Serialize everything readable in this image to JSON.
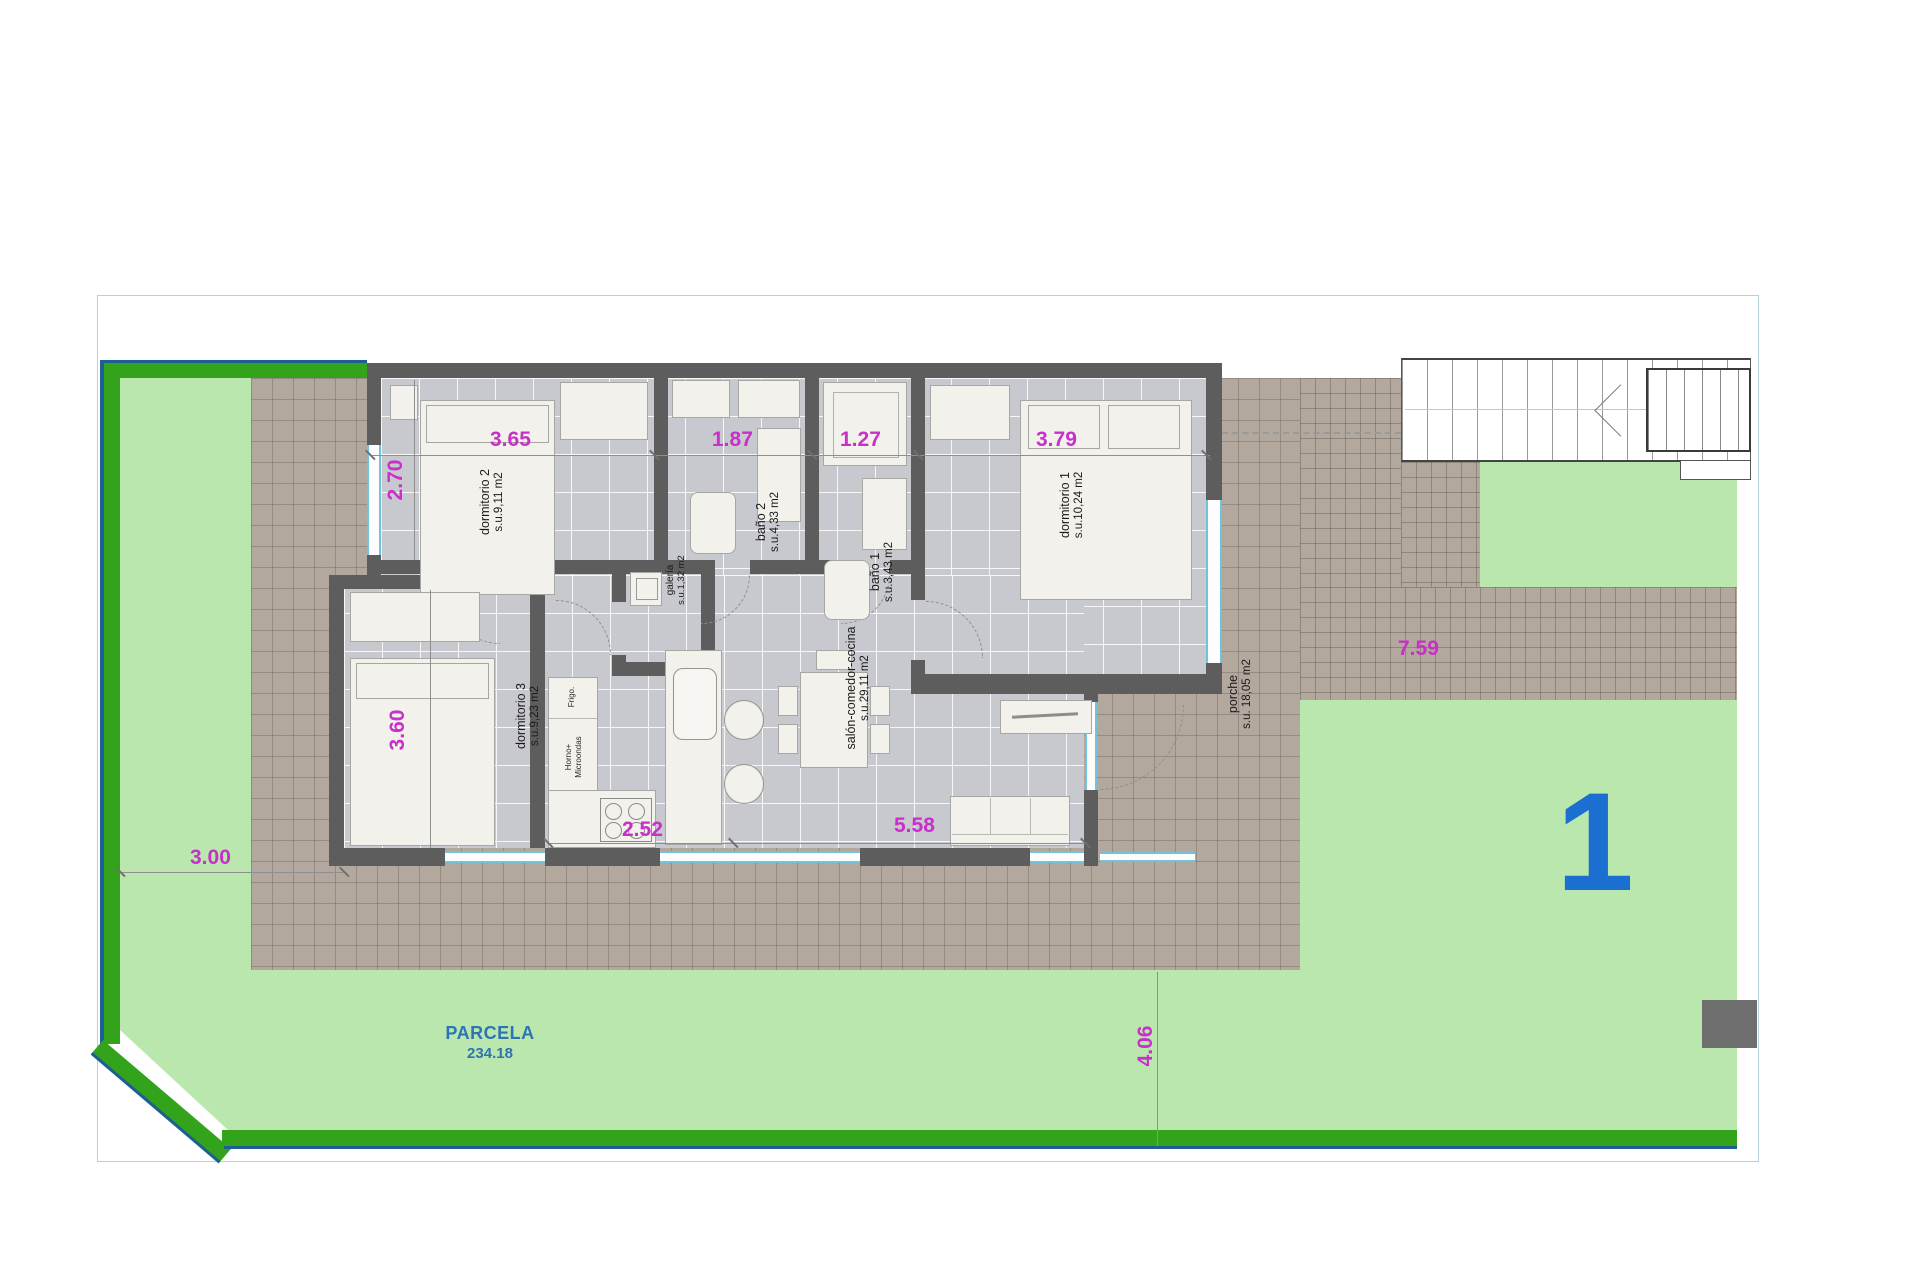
{
  "plan": {
    "unit_number": "1",
    "parcel": {
      "label": "PARCELA",
      "area": "234.18"
    },
    "rooms": {
      "dormitorio2": {
        "name": "dormitorio 2",
        "area": "s.u.9,11 m2"
      },
      "bano2": {
        "name": "baño 2",
        "area": "s.u.4,33 m2"
      },
      "bano1": {
        "name": "baño 1",
        "area": "s.u.3,43 m2"
      },
      "dormitorio1": {
        "name": "dormitorio 1",
        "area": "s.u.10,24 m2"
      },
      "galeria": {
        "name": "galería",
        "area": "s.u.1,32 m2"
      },
      "dormitorio3": {
        "name": "dormitorio 3",
        "area": "s.u.9,23 m2"
      },
      "salon": {
        "name": "salón-comedor-cocina",
        "area": "s.u.29,11 m2"
      },
      "porche": {
        "name": "porche",
        "area": "s.u. 18,05 m2"
      }
    },
    "kitchen": {
      "fridge": "Frigo.",
      "oven_line1": "Horno+",
      "oven_line2": "Microondas"
    },
    "dimensions": {
      "dorm2_width": "3.65",
      "bano2_width": "1.87",
      "bano1_width": "1.27",
      "dorm1_width": "3.79",
      "dorm2_height": "2.70",
      "dorm3_height": "3.60",
      "kitchen_width": "2.52",
      "salon_width": "5.58",
      "left_setback": "3.00",
      "walkway_length": "7.59",
      "right_setback": "4.06"
    },
    "colors": {
      "lawn": "#b9e7ae",
      "hedge_green": "#33a31c",
      "boundary_blue": "#1d5f95",
      "terrace_tile": "#b2a89d",
      "indoor_tile": "#c8c8cf",
      "wall": "#5d5d5d",
      "dimension_magenta": "#c92fc9",
      "parcel_text_blue": "#2e74b5",
      "unit_number_blue": "#1b6fd0",
      "window_teal": "#6fc3da"
    }
  }
}
